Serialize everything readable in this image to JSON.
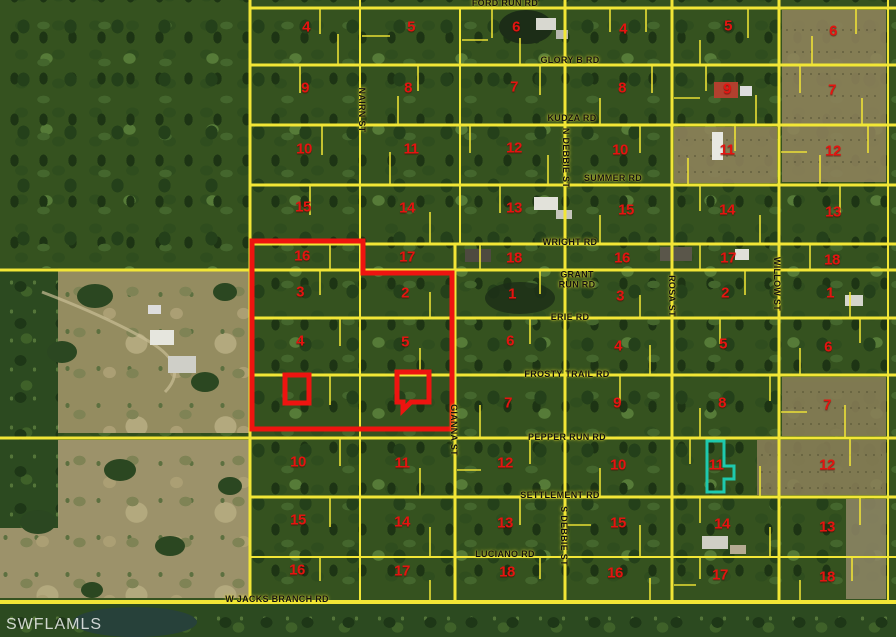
{
  "map": {
    "watermark": "SWFLAMLS",
    "colors": {
      "parcel_lines": "#f2e636",
      "lot_numbers": "#e41410",
      "subject_outline": "#ee1410",
      "highlight_parcel": "#1ec9ae",
      "road_labels": "#111111"
    },
    "roads": [
      {
        "name": "FORD RUN RD",
        "x": 505,
        "y": 3
      },
      {
        "name": "GLORY B RD",
        "x": 570,
        "y": 60
      },
      {
        "name": "KUDZA RD",
        "x": 572,
        "y": 118
      },
      {
        "name": "SUMMER RD",
        "x": 613,
        "y": 178
      },
      {
        "name": "WRIGHT RD",
        "x": 570,
        "y": 242
      },
      {
        "name": "GRANT RUN RD",
        "x": 577,
        "y": 280,
        "w": 44
      },
      {
        "name": "ERIE RD",
        "x": 570,
        "y": 317
      },
      {
        "name": "FROSTY TRAIL RD",
        "x": 567,
        "y": 374
      },
      {
        "name": "PEPPER RUN RD",
        "x": 567,
        "y": 437
      },
      {
        "name": "SETTLEMENT RD",
        "x": 560,
        "y": 495
      },
      {
        "name": "LUCIANO RD",
        "x": 505,
        "y": 554
      },
      {
        "name": "W JACKS BRANCH RD",
        "x": 277,
        "y": 599
      }
    ],
    "streets": [
      {
        "name": "NAIRN ST",
        "x": 362,
        "y": 110
      },
      {
        "name": "N DEBBIE ST",
        "x": 566,
        "y": 158
      },
      {
        "name": "ROSA ST",
        "x": 672,
        "y": 296
      },
      {
        "name": "WILLOW ST",
        "x": 777,
        "y": 284
      },
      {
        "name": "GIANNA ST",
        "x": 454,
        "y": 430
      },
      {
        "name": "S DEBBIE ST",
        "x": 564,
        "y": 536
      }
    ],
    "lot_numbers": [
      {
        "n": "4",
        "x": 306,
        "y": 27
      },
      {
        "n": "5",
        "x": 411,
        "y": 27
      },
      {
        "n": "6",
        "x": 516,
        "y": 27
      },
      {
        "n": "4",
        "x": 623,
        "y": 29
      },
      {
        "n": "5",
        "x": 728,
        "y": 26
      },
      {
        "n": "6",
        "x": 833,
        "y": 31
      },
      {
        "n": "9",
        "x": 305,
        "y": 88
      },
      {
        "n": "8",
        "x": 408,
        "y": 88
      },
      {
        "n": "7",
        "x": 514,
        "y": 87
      },
      {
        "n": "8",
        "x": 622,
        "y": 88
      },
      {
        "n": "9",
        "x": 727,
        "y": 89
      },
      {
        "n": "7",
        "x": 832,
        "y": 90
      },
      {
        "n": "10",
        "x": 304,
        "y": 149
      },
      {
        "n": "11",
        "x": 411,
        "y": 149
      },
      {
        "n": "12",
        "x": 514,
        "y": 148
      },
      {
        "n": "10",
        "x": 620,
        "y": 150
      },
      {
        "n": "11",
        "x": 727,
        "y": 150
      },
      {
        "n": "12",
        "x": 833,
        "y": 151
      },
      {
        "n": "15",
        "x": 303,
        "y": 207
      },
      {
        "n": "14",
        "x": 407,
        "y": 208
      },
      {
        "n": "13",
        "x": 514,
        "y": 208
      },
      {
        "n": "15",
        "x": 626,
        "y": 210
      },
      {
        "n": "14",
        "x": 727,
        "y": 210
      },
      {
        "n": "13",
        "x": 833,
        "y": 212
      },
      {
        "n": "16",
        "x": 302,
        "y": 256
      },
      {
        "n": "17",
        "x": 407,
        "y": 257
      },
      {
        "n": "18",
        "x": 514,
        "y": 258
      },
      {
        "n": "16",
        "x": 622,
        "y": 258
      },
      {
        "n": "17",
        "x": 728,
        "y": 258
      },
      {
        "n": "18",
        "x": 832,
        "y": 260
      },
      {
        "n": "3",
        "x": 300,
        "y": 292
      },
      {
        "n": "2",
        "x": 405,
        "y": 293
      },
      {
        "n": "1",
        "x": 512,
        "y": 294
      },
      {
        "n": "3",
        "x": 620,
        "y": 296
      },
      {
        "n": "2",
        "x": 725,
        "y": 293
      },
      {
        "n": "1",
        "x": 830,
        "y": 293
      },
      {
        "n": "4",
        "x": 300,
        "y": 341
      },
      {
        "n": "5",
        "x": 405,
        "y": 342
      },
      {
        "n": "6",
        "x": 510,
        "y": 341
      },
      {
        "n": "4",
        "x": 618,
        "y": 346
      },
      {
        "n": "5",
        "x": 723,
        "y": 344
      },
      {
        "n": "6",
        "x": 828,
        "y": 347
      },
      {
        "n": "7",
        "x": 508,
        "y": 403
      },
      {
        "n": "9",
        "x": 617,
        "y": 403
      },
      {
        "n": "8",
        "x": 722,
        "y": 403
      },
      {
        "n": "7",
        "x": 827,
        "y": 405
      },
      {
        "n": "10",
        "x": 298,
        "y": 462
      },
      {
        "n": "11",
        "x": 402,
        "y": 463
      },
      {
        "n": "12",
        "x": 505,
        "y": 463
      },
      {
        "n": "10",
        "x": 618,
        "y": 465
      },
      {
        "n": "11",
        "x": 716,
        "y": 465
      },
      {
        "n": "12",
        "x": 827,
        "y": 465
      },
      {
        "n": "15",
        "x": 298,
        "y": 520
      },
      {
        "n": "14",
        "x": 402,
        "y": 522
      },
      {
        "n": "13",
        "x": 505,
        "y": 523
      },
      {
        "n": "15",
        "x": 618,
        "y": 523
      },
      {
        "n": "14",
        "x": 722,
        "y": 524
      },
      {
        "n": "13",
        "x": 827,
        "y": 527
      },
      {
        "n": "16",
        "x": 297,
        "y": 570
      },
      {
        "n": "17",
        "x": 402,
        "y": 571
      },
      {
        "n": "18",
        "x": 507,
        "y": 572
      },
      {
        "n": "16",
        "x": 615,
        "y": 573
      },
      {
        "n": "17",
        "x": 720,
        "y": 575
      },
      {
        "n": "18",
        "x": 827,
        "y": 577
      }
    ]
  }
}
